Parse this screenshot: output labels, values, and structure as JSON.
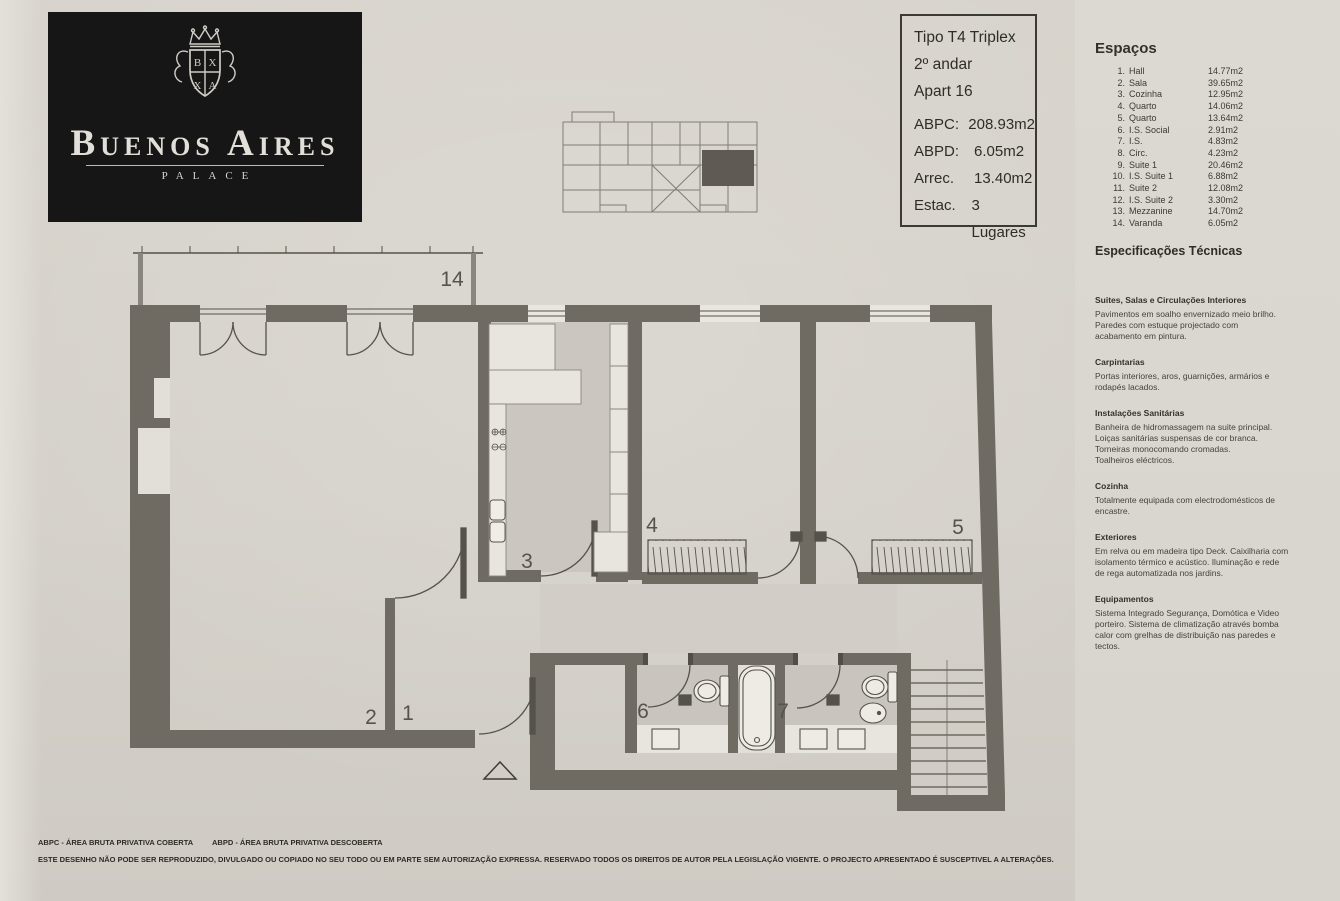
{
  "colors": {
    "paper": "#d6d2cb",
    "wall": "#6f6b62",
    "ink": "#34322c",
    "logo_bg": "#161616"
  },
  "logo_card": {
    "title": "Buenos Aires",
    "subtitle": "PALACE"
  },
  "info_box": {
    "type": "Tipo T4 Triplex",
    "floor": "2º andar",
    "apartment": "Apart 16",
    "metrics": [
      {
        "label": "ABPC:",
        "value": "208.93m2"
      },
      {
        "label": "ABPD:",
        "value": "6.05m2"
      },
      {
        "label": "Arrec.",
        "value": "13.40m2"
      },
      {
        "label": "Estac.",
        "value": "3 Lugares"
      }
    ]
  },
  "spaces_panel": {
    "title": "Espaços",
    "items": [
      {
        "num": "1.",
        "name": "Hall",
        "area": "14.77m2"
      },
      {
        "num": "2.",
        "name": "Sala",
        "area": "39.65m2"
      },
      {
        "num": "3.",
        "name": "Cozinha",
        "area": "12.95m2"
      },
      {
        "num": "4.",
        "name": "Quarto",
        "area": "14.06m2"
      },
      {
        "num": "5.",
        "name": "Quarto",
        "area": "13.64m2"
      },
      {
        "num": "6.",
        "name": "I.S. Social",
        "area": "2.91m2"
      },
      {
        "num": "7.",
        "name": "I.S.",
        "area": "4.83m2"
      },
      {
        "num": "8.",
        "name": "Circ.",
        "area": "4.23m2"
      },
      {
        "num": "9.",
        "name": "Suite 1",
        "area": "20.46m2"
      },
      {
        "num": "10.",
        "name": "I.S. Suite 1",
        "area": "6.88m2"
      },
      {
        "num": "11.",
        "name": "Suite 2",
        "area": "12.08m2"
      },
      {
        "num": "12.",
        "name": "I.S. Suite 2",
        "area": "3.30m2"
      },
      {
        "num": "13.",
        "name": "Mezzanine",
        "area": "14.70m2"
      },
      {
        "num": "14.",
        "name": "Varanda",
        "area": "6.05m2"
      }
    ]
  },
  "specs_panel": {
    "title": "Especificações Técnicas",
    "sections": [
      {
        "heading": "Suites, Salas e Circulações Interiores",
        "body": "Pavimentos em soalho envernizado meio brilho.\nParedes com estuque projectado com\nacabamento em pintura."
      },
      {
        "heading": "Carpintarias",
        "body": "Portas interiores, aros, guarnições, armários e\nrodapés lacados."
      },
      {
        "heading": "Instalações Sanitárias",
        "body": "Banheira de hidromassagem na suite principal.\nLoiças sanitárias suspensas de cor branca.\nTorneiras monocomando cromadas.\nToalheiros eléctricos."
      },
      {
        "heading": "Cozinha",
        "body": "Totalmente equipada com electrodomésticos de\nencastre."
      },
      {
        "heading": "Exteriores",
        "body": "Em relva ou em madeira tipo Deck. Caixilharia com\nisolamento térmico e acústico. Iluminação e rede\nde rega automatizada nos jardins."
      },
      {
        "heading": "Equipamentos",
        "body": "Sistema Integrado Segurança, Domótica e Video\nporteiro. Sistema de climatização através bomba\ncalor com grelhas de distribuição nas paredes e\ntectos."
      }
    ]
  },
  "plan": {
    "labels": {
      "hall": "1",
      "sala": "2",
      "cozinha": "3",
      "quarto_4": "4",
      "quarto_5": "5",
      "is_social": "6",
      "is_7": "7",
      "varanda": "14"
    }
  },
  "footer": {
    "legend_abpc": "ABPC - ÁREA BRUTA PRIVATIVA COBERTA",
    "legend_abpd": "ABPD - ÁREA BRUTA PRIVATIVA DESCOBERTA",
    "disclaimer": "ESTE DESENHO NÃO PODE SER REPRODUZIDO, DIVULGADO OU COPIADO NO SEU TODO OU EM PARTE SEM AUTORIZAÇÃO EXPRESSA. RESERVADO TODOS OS DIREITOS DE AUTOR PELA LEGISLAÇÃO VIGENTE. O PROJECTO APRESENTADO É SUSCEPTIVEL A ALTERAÇÕES."
  },
  "branding": {
    "cdi_letters": {
      "c": "C",
      "d": "D",
      "i": "I"
    },
    "agency_left": "Quintela",
    "agency_right": "Penalva",
    "agency_sub": "associados"
  }
}
